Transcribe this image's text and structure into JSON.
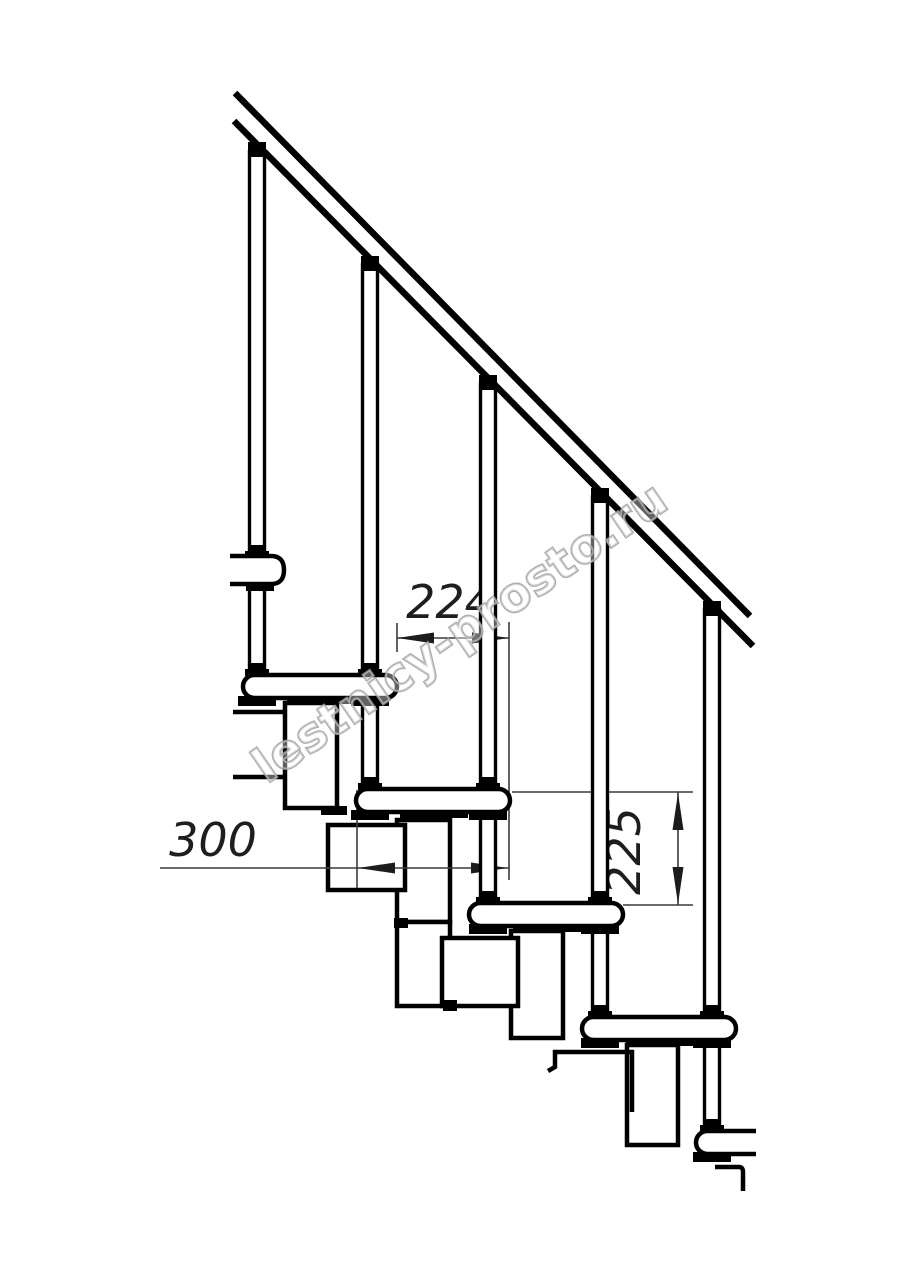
{
  "page": {
    "background_color": "#ffffff",
    "line_color": "#000000",
    "dimension_line_color": "#3a3a3a",
    "content_type": "staircase technical side-view drawing"
  },
  "drawing": {
    "dimensions": {
      "step_run": "224",
      "tread_depth": "300",
      "step_rise": "225"
    },
    "structure": {
      "handrail": "diagonal handrail, two parallel lines",
      "baluster_count": 5,
      "tread_count": 5,
      "module_chain": "zigzag step modules under treads"
    },
    "watermark": {
      "text": "lestnicy-prosto.ru",
      "color": "#9e9e9e"
    }
  }
}
